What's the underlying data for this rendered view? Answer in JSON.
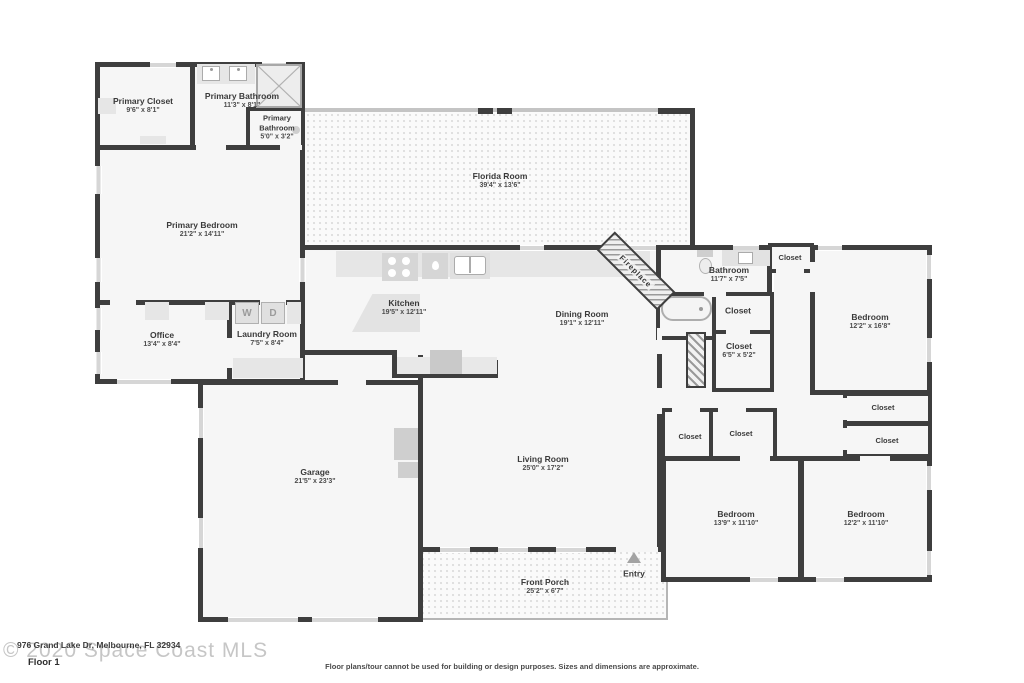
{
  "plan": {
    "rooms": {
      "primary_closet": {
        "name": "Primary Closet",
        "dims": "9'6\" x 8'1\""
      },
      "primary_bathroom": {
        "name": "Primary Bathroom",
        "dims": "11'3\" x 8'1\""
      },
      "primary_bathroom_2": {
        "name": "Primary Bathroom",
        "dims": "5'0\" x 3'2\""
      },
      "primary_bedroom": {
        "name": "Primary Bedroom",
        "dims": "21'2\" x 14'11\""
      },
      "office": {
        "name": "Office",
        "dims": "13'4\" x 8'4\""
      },
      "laundry_room": {
        "name": "Laundry Room",
        "dims": "7'5\" x 8'4\""
      },
      "florida_room": {
        "name": "Florida Room",
        "dims": "39'4\" x 13'6\""
      },
      "kitchen": {
        "name": "Kitchen",
        "dims": "19'5\" x 12'11\""
      },
      "dining_room": {
        "name": "Dining Room",
        "dims": "19'1\" x 12'11\""
      },
      "bathroom": {
        "name": "Bathroom",
        "dims": "11'7\" x 7'5\""
      },
      "bedroom_right": {
        "name": "Bedroom",
        "dims": "12'2\" x 16'8\""
      },
      "closet_hall_small": {
        "name": "Closet"
      },
      "closet_bath": {
        "name": "Closet"
      },
      "closet_hall": {
        "name": "Closet",
        "dims": "6'5\" x 5'2\""
      },
      "closet_right_top": {
        "name": "Closet"
      },
      "closet_right_bottom": {
        "name": "Closet"
      },
      "garage": {
        "name": "Garage",
        "dims": "21'5\" x 23'3\""
      },
      "living_room": {
        "name": "Living Room",
        "dims": "25'0\" x 17'2\""
      },
      "closet_bed2_left": {
        "name": "Closet"
      },
      "closet_bed2_right": {
        "name": "Closet"
      },
      "bedroom_bottom_left": {
        "name": "Bedroom",
        "dims": "13'9\" x 11'10\""
      },
      "bedroom_bottom_right": {
        "name": "Bedroom",
        "dims": "12'2\" x 11'10\""
      },
      "front_porch": {
        "name": "Front Porch",
        "dims": "25'2\" x 6'7\""
      }
    },
    "annotations": {
      "fireplace": "Fireplace",
      "entry": "Entry",
      "washer": "W",
      "dryer": "D"
    }
  },
  "footer": {
    "floor_label": "Floor 1",
    "watermark": "© 2020 Space Coast MLS",
    "address": "976 Grand Lake Dr, Melbourne, FL 32934",
    "disclaimer": "Floor plans/tour cannot be used for building or design purposes. Sizes and dimensions are approximate."
  },
  "colors": {
    "wall": "#3e3e3e",
    "room_fill": "#f6f6f6",
    "texture_dot": "#dedede"
  }
}
